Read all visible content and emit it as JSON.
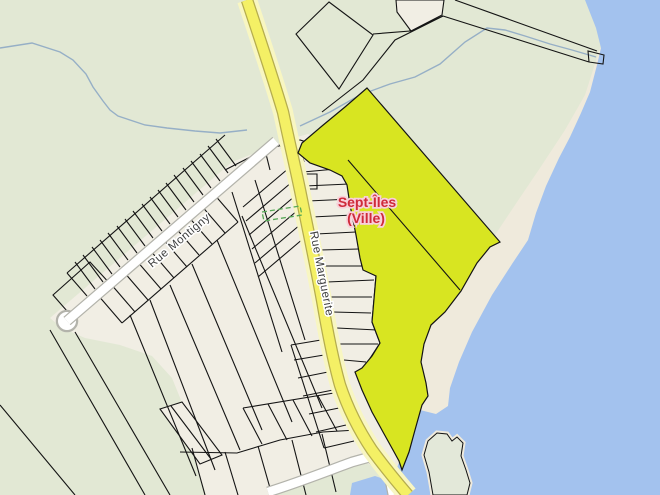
{
  "map": {
    "labels": {
      "city_line1": "Sept-Îles",
      "city_line2": "(Ville)",
      "street_montigny": "Rue Montigny",
      "street_marguerite": "Rue Marguerite"
    },
    "colors": {
      "land": "#e2e8d4",
      "parcel": "#f1eee4",
      "beach": "#efeadc",
      "water": "#a3c2ee",
      "island": "#e3e8d9",
      "stream": "#96afc6",
      "highlight": "#d8e521",
      "roady": "#f4f065",
      "roadycase": "#f8f6c2",
      "roadyborder": "#b5ad4e",
      "roadw": "#ffffff",
      "roadwcase": "#b3b3ab",
      "dashed": "#56a856",
      "streetlbl": "#3f4040",
      "citylbl": "#cf2a3a",
      "cityhalo": "#f8d0da"
    }
  }
}
